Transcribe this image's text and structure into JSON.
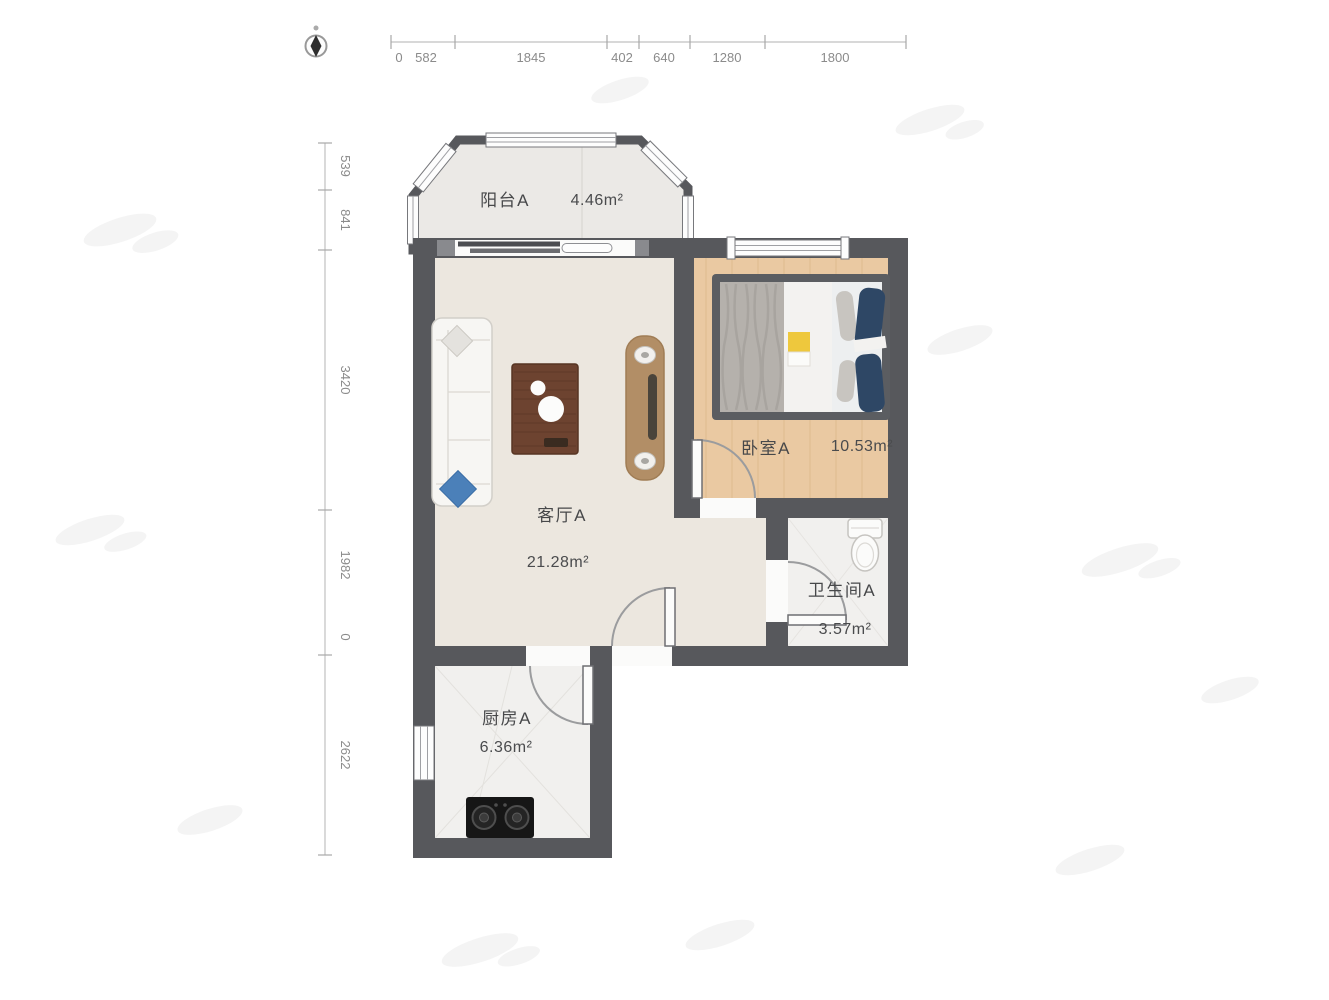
{
  "compass": {
    "icon": "compass-north-icon"
  },
  "rulers": {
    "top": {
      "labels": [
        "0",
        "582",
        "1845",
        "402",
        "640",
        "1280",
        "1800"
      ]
    },
    "left": {
      "labels": [
        "539",
        "841",
        "3420",
        "1982",
        "0",
        "2622"
      ]
    }
  },
  "rooms": {
    "balcony": {
      "name": "阳台A",
      "area": "4.46m²"
    },
    "living": {
      "name": "客厅A",
      "area": "21.28m²"
    },
    "bedroom": {
      "name": "卧室A",
      "area": "10.53m²"
    },
    "bathroom": {
      "name": "卫生间A",
      "area": "3.57m²"
    },
    "kitchen": {
      "name": "厨房A",
      "area": "6.36m²"
    }
  },
  "colors": {
    "wall": "#57585c",
    "living_floor": "#ece7df",
    "bedroom_floor": "#eac9a2",
    "tile_floor": "#f1f0ee",
    "balcony_floor": "#ebe9e6",
    "pillow_navy": "#2e4765",
    "cushion_blue": "#4b80b9",
    "table_wood": "#6d4330",
    "tv_stand_wood": "#b28e66",
    "dimension_text": "#8b8b8b",
    "label_text": "#47484a"
  }
}
